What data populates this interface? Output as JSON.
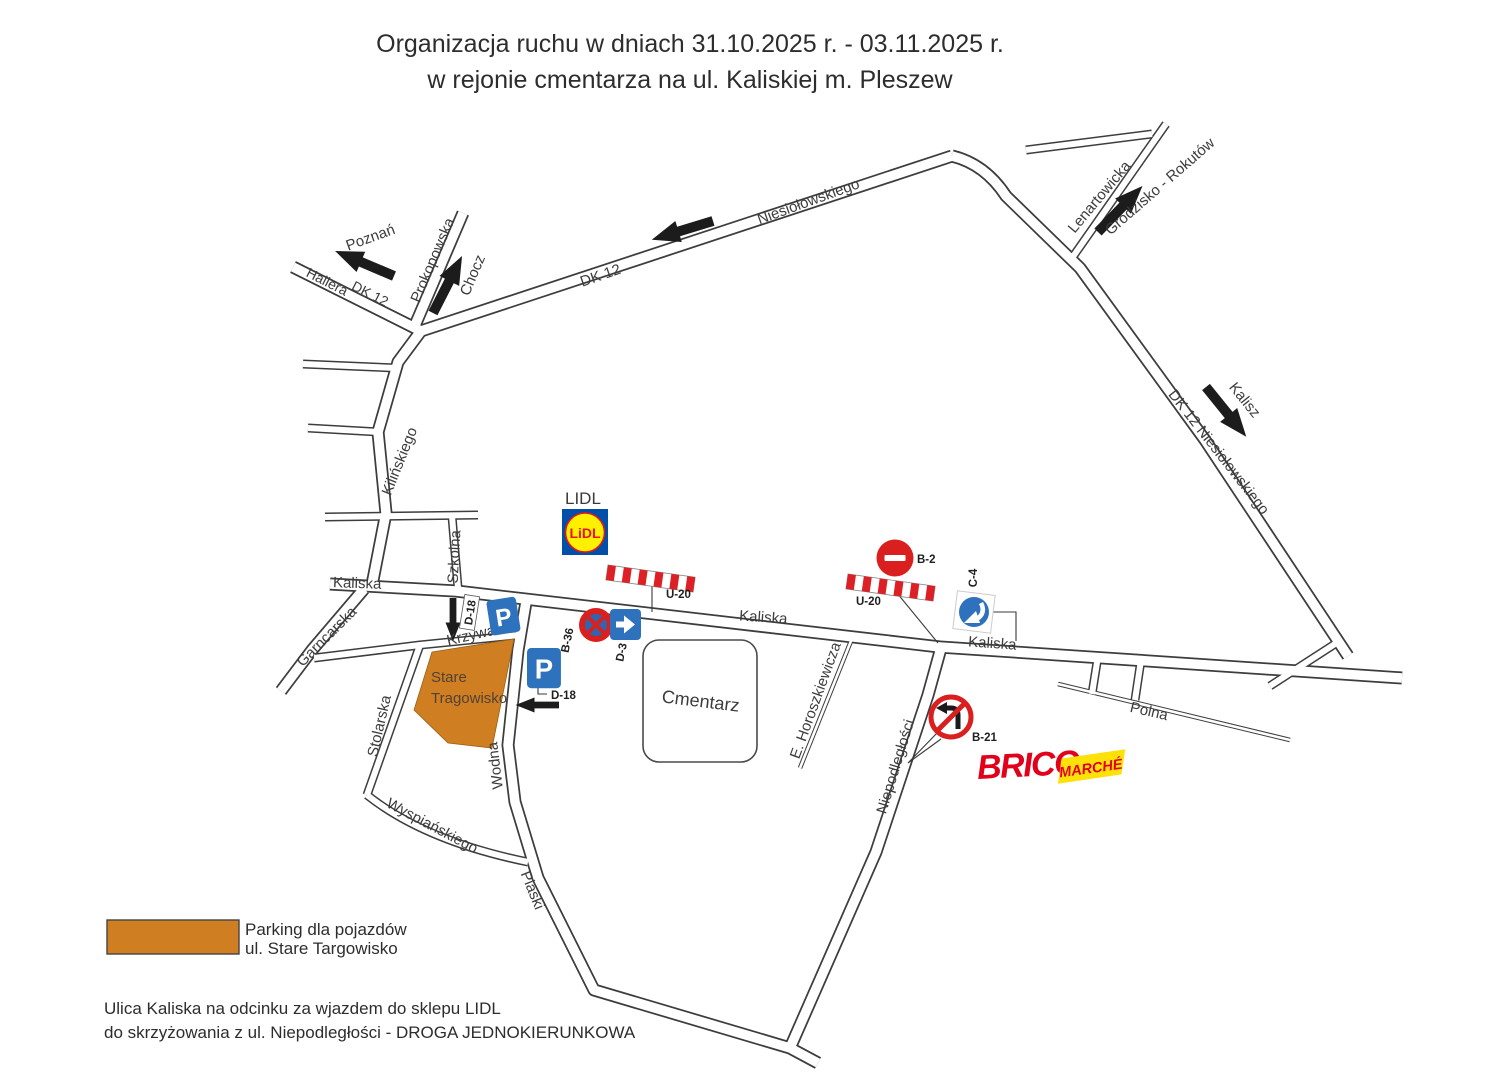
{
  "title": {
    "line1": "Organizacja ruchu w dniach 31.10.2025 r. - 03.11.2025 r.",
    "line2": "w rejonie cmentarza na ul. Kaliskiej m. Pleszew"
  },
  "streets": {
    "hallera": "Hallera",
    "dk12_on_hallera": "DK 12",
    "dk12_northwest": "DK 12",
    "prokopowska": "Prokopowska",
    "niesiolowskiego": "Niesiołowskiego",
    "lenartowicka": "Lenartowicka",
    "dk12_east": "DK 12  Niesiołowskiego",
    "kilinskiego": "Kilińskiego",
    "szkolna": "Szkolna",
    "kaliska_west": "Kaliska",
    "kaliska_center": "Kaliska",
    "kaliska_east": "Kaliska",
    "garncarska": "Garncarska",
    "krzywa": "Krzywa",
    "stolarska": "Stolarska",
    "wyspianskiego": "Wyspiańskiego",
    "wodna": "Wodna",
    "piaski": "Piaski",
    "horoszkiewicza": "E. Horoszkiewicza",
    "niepodleglosci": "Niepodległości",
    "polna": "Polna"
  },
  "directions": {
    "poznan": "Poznań",
    "chocz": "Chocz",
    "grodzisko_rokutow": "Grodzisko - Rokutów",
    "kalisz": "Kalisz"
  },
  "places": {
    "cemetery": "Cmentarz",
    "market_line1": "Stare",
    "market_line2": "Tragowisko",
    "lidl_caption": "LIDL",
    "lidl_logo_text": "LiDL",
    "brico_text": "BRICO",
    "marche_text": "MARCHÉ"
  },
  "sign_labels": {
    "u20_west": "U-20",
    "u20_east": "U-20",
    "b2": "B-2",
    "c4": "C-4",
    "b36": "B-36",
    "d3": "D-3",
    "d18_upper": "D-18",
    "d18_lower": "D-18",
    "b21": "B-21",
    "p_symbol": "P"
  },
  "legend": {
    "swatch_color": "#cf7e22",
    "line1": "Parking dla pojazdów",
    "line2": "ul. Stare Targowisko"
  },
  "footnote": {
    "line1": "Ulica Kaliska na odcinku za wjazdem do sklepu LIDL",
    "line2": "do skrzyżowania z ul. Niepodległości - DROGA JEDNOKIERUNKOWA"
  },
  "colors": {
    "parking_orange": "#cf7e22",
    "sign_red": "#d9201f",
    "sign_blue": "#2e72bd",
    "lidl_blue": "#0050aa",
    "lidl_yellow": "#fff000",
    "lidl_red": "#e8141c",
    "brico_red": "#e2001a",
    "marche_yellow": "#ffe10a",
    "road_outline": "#3d3d3d",
    "text": "#3c3c3c"
  }
}
